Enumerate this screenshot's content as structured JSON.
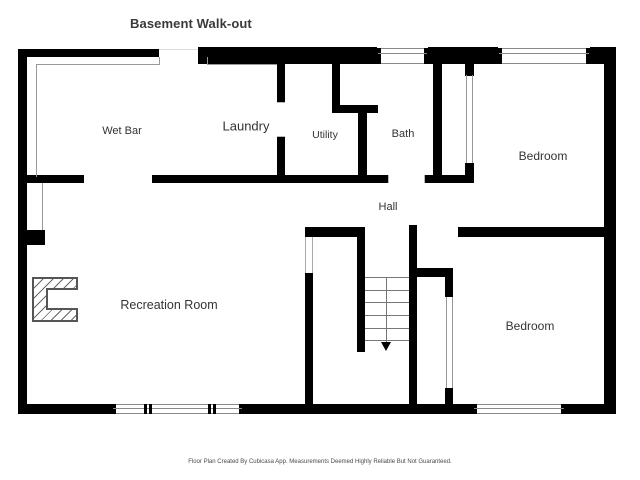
{
  "title": "Basement Walk-out",
  "rooms": {
    "wet_bar": "Wet Bar",
    "laundry": "Laundry",
    "utility": "Utility",
    "bath": "Bath",
    "bedroom1": "Bedroom",
    "hall": "Hall",
    "recreation": "Recreation Room",
    "bedroom2": "Bedroom"
  },
  "footer": "Floor Plan Created By Cubicasa App. Measurements Deemed Highly Reliable But Not Guaranteed.",
  "icons": {
    "fireplace": "fireplace-icon",
    "stairs_arrow": "stairs-down-arrow-icon",
    "window": "window-symbol",
    "stairs": "staircase-symbol"
  },
  "colors": {
    "wall": "#000000",
    "thin_line": "#999999",
    "window_line": "#8a8a8a",
    "text": "#333333",
    "background": "#ffffff"
  }
}
